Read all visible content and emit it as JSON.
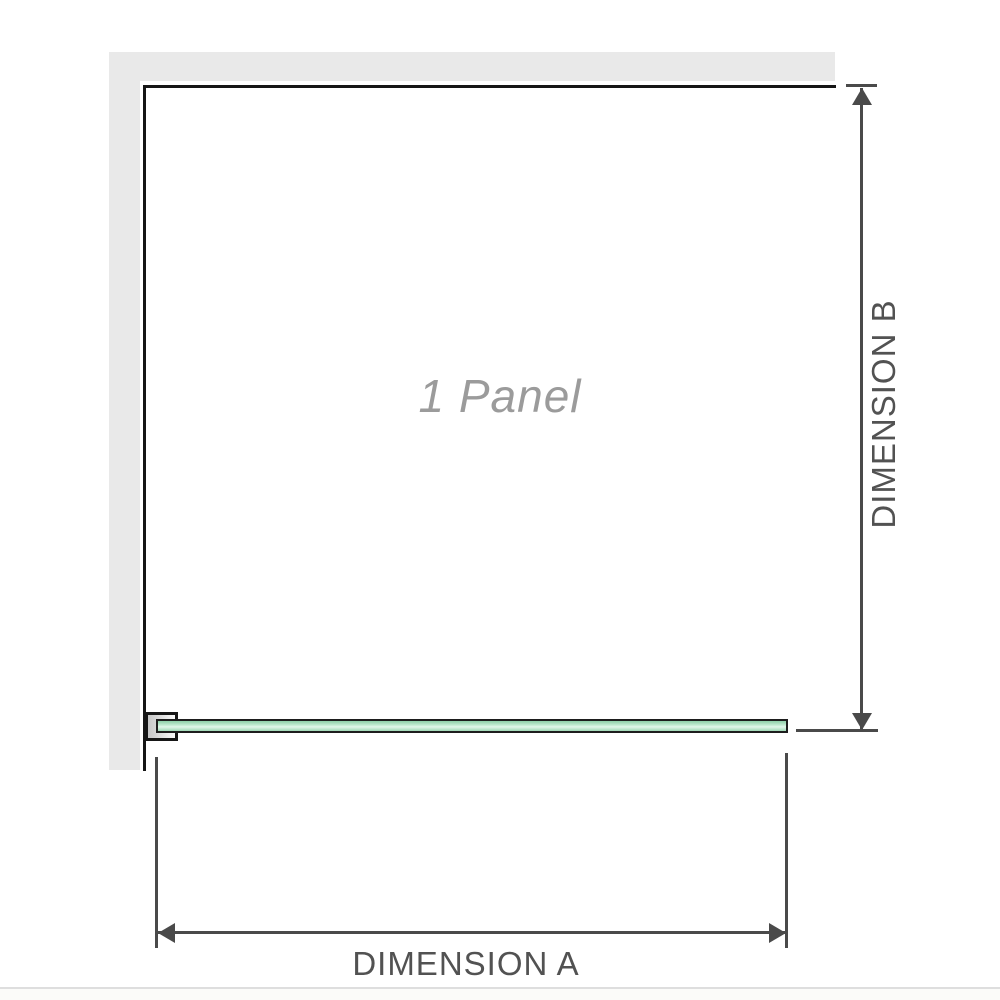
{
  "diagram": {
    "panel_label": "1 Panel",
    "dimension_a_label": "DIMENSION A",
    "dimension_b_label": "DIMENSION B"
  },
  "colors": {
    "background": "#ffffff",
    "wall_fill": "#e9e9e9",
    "wall_edge": "#161616",
    "dimension_line": "#4a4a4a",
    "dimension_text": "#525252",
    "panel_text": "#9b9b9b",
    "glass_border": "#1d1d1d",
    "glass_green": "#9fd8b6",
    "glass_green_light": "#e2f6ea",
    "bracket_gray": "#c6c6c6",
    "page_edge": "#dedede"
  }
}
